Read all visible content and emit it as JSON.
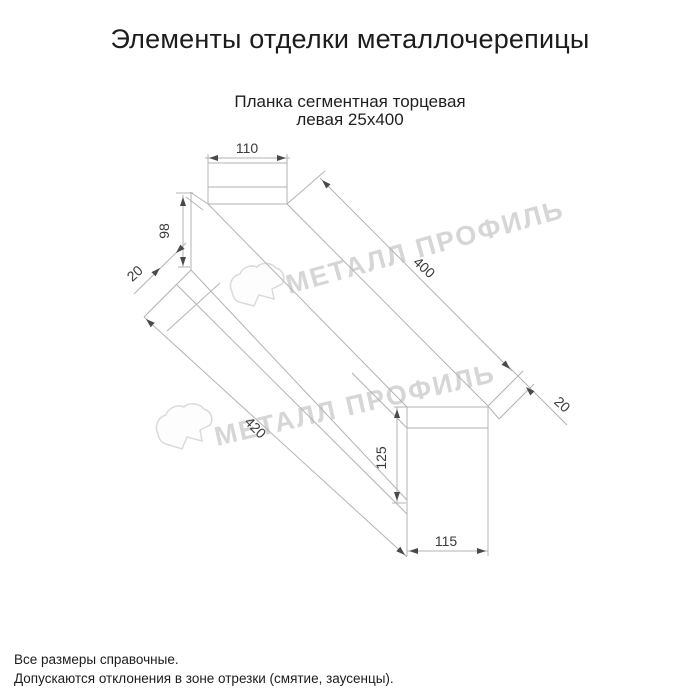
{
  "title": "Элементы отделки металлочерепицы",
  "subtitle": {
    "line1": "Планка сегментная торцевая",
    "line2": "левая 25х400"
  },
  "drawing": {
    "type": "technical-dimension-drawing",
    "dimensions": {
      "top_width": "110",
      "left_height": "98",
      "left_fold": "20",
      "length_top": "400",
      "right_fold": "20",
      "length_bottom": "420",
      "right_height": "125",
      "bottom_width": "115"
    },
    "line_color": "#b3b3b3",
    "dim_text_color": "#3a3a3a"
  },
  "watermark": {
    "text": "МЕТАЛЛ ПРОФИЛЬ",
    "color": "#d6d6d6"
  },
  "footer": {
    "line1": "Все размеры справочные.",
    "line2": "Допускаются отклонения в зоне отрезки (смятие, заусенцы)."
  }
}
